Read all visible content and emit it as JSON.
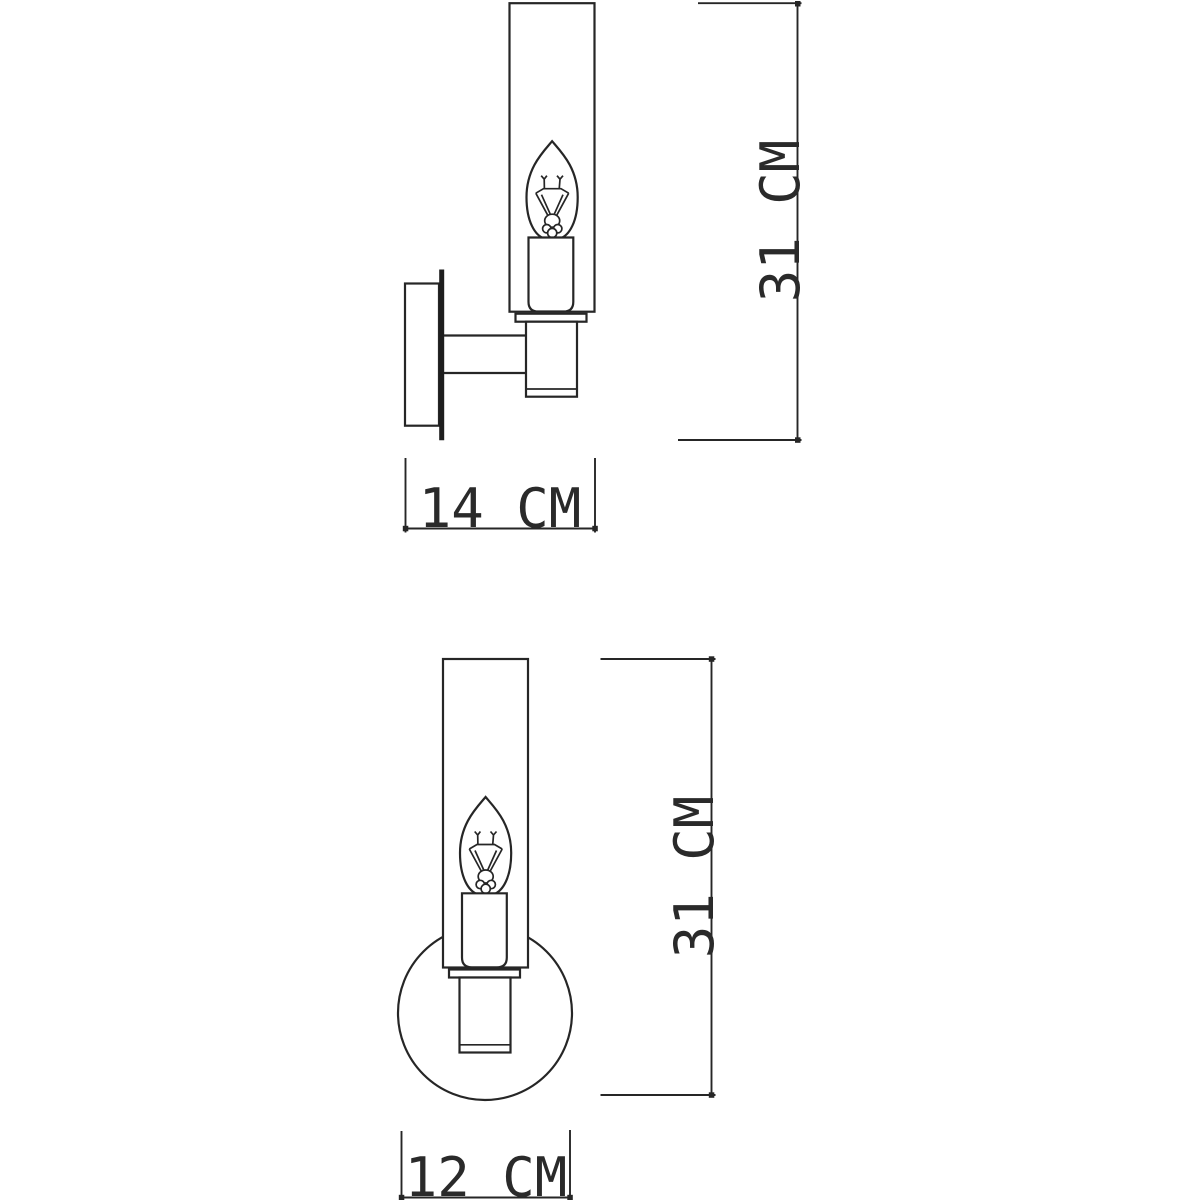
{
  "page": {
    "background": "#ffffff"
  },
  "drawing": {
    "type": "technical-dimension-drawing",
    "subject": "wall-sconce-with-cylindrical-glass-shade-and-candle-bulb",
    "line_color": "#262626",
    "text_color": "#2a2a2a",
    "views": {
      "side_view": {
        "name": "side-view",
        "label_height": "31 CM",
        "label_width": "14 CM",
        "height_cm": 31,
        "width_cm": 14
      },
      "front_view": {
        "name": "front-view",
        "label_height": "31 CM",
        "label_width": "12 CM",
        "height_cm": 31,
        "width_cm": 12
      }
    }
  }
}
